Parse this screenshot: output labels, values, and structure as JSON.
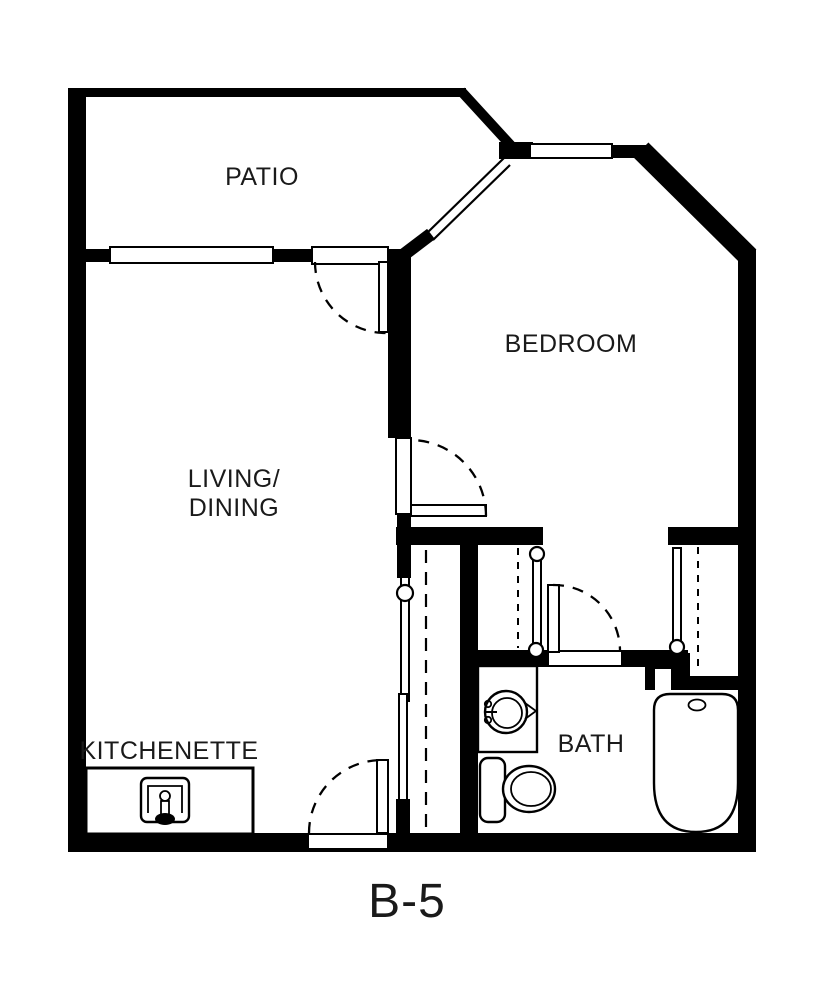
{
  "unit": {
    "label": "B-5"
  },
  "rooms": {
    "patio": {
      "label": "PATIO"
    },
    "bedroom": {
      "label": "BEDROOM"
    },
    "living_dining": {
      "line1": "LIVING/",
      "line2": "DINING"
    },
    "kitchenette": {
      "label": "KITCHENETTE"
    },
    "bath": {
      "label": "BATH"
    }
  },
  "fixtures": {
    "kitchen_sink": "kitchen-sink",
    "vanity_sink": "vanity-sink",
    "toilet": "toilet",
    "bathtub": "bathtub"
  },
  "colors": {
    "wall": "#000000",
    "background": "#ffffff",
    "text": "#1a1a1a"
  }
}
